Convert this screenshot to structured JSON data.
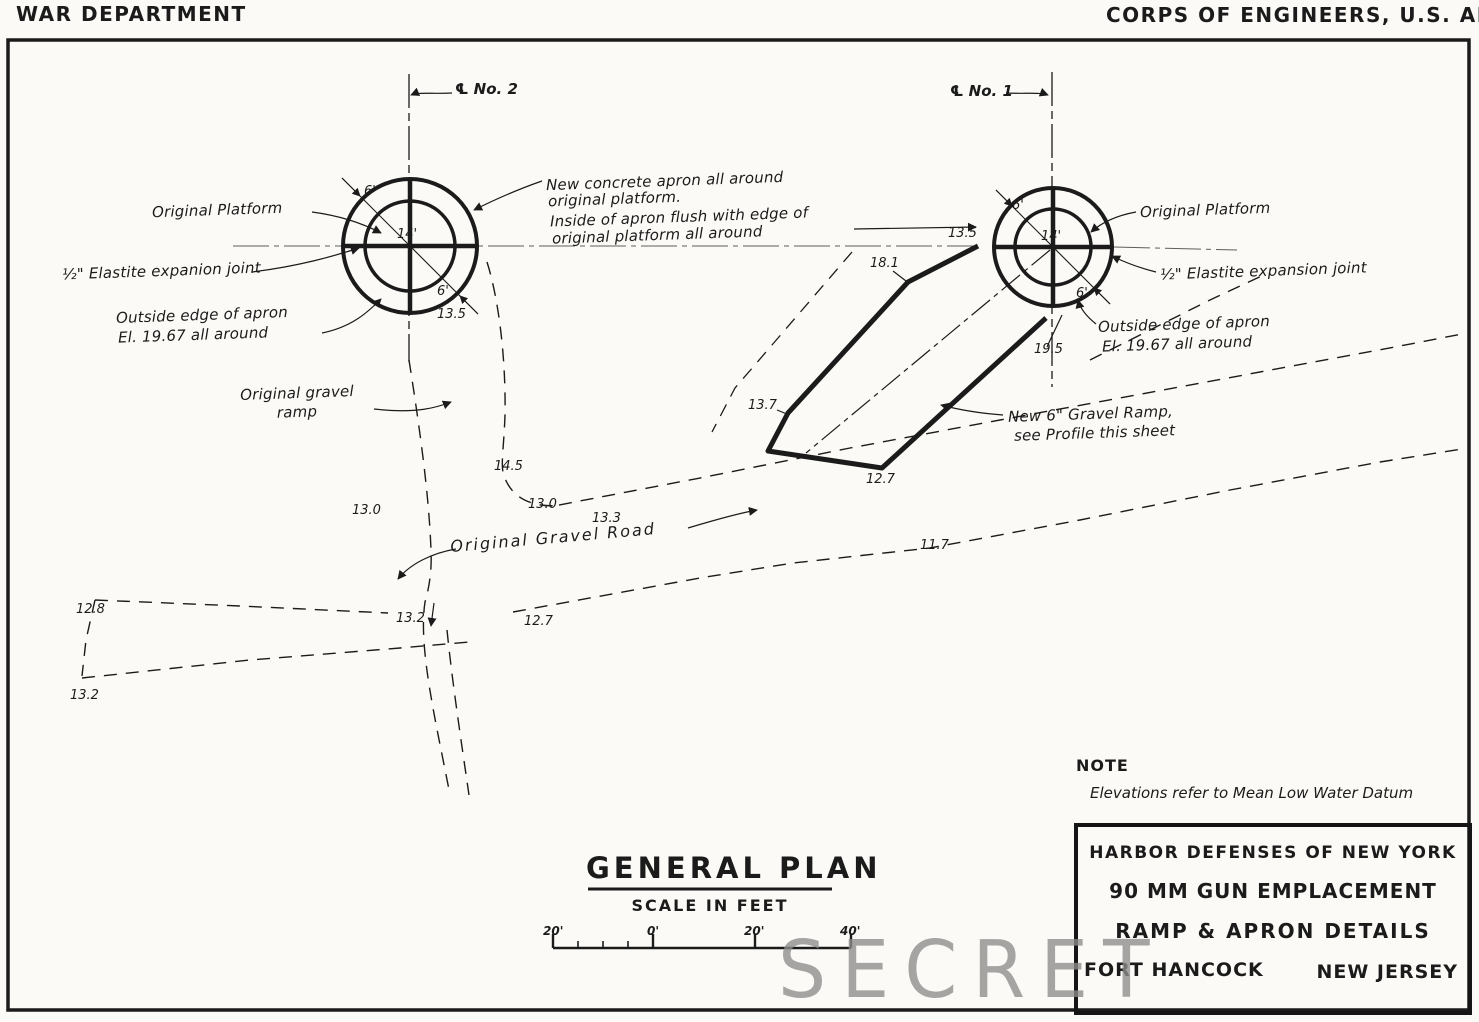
{
  "header": {
    "war_department": "WAR DEPARTMENT",
    "corps": "CORPS OF ENGINEERS, U.S. ARMY"
  },
  "emplacement_left": {
    "centerline_label": "℄ No. 2",
    "platform_label": "Original Platform",
    "joint_label": "½\" Elastite expanion joint",
    "apron_edge_line1": "Outside edge of apron",
    "apron_edge_line2": "El. 19.67 all around",
    "dim_apron_upper": "6'",
    "dim_platform": "14'",
    "dim_apron_lower": "6'",
    "elevation": "13.5"
  },
  "emplacement_right": {
    "centerline_label": "℄ No. 1",
    "platform_label": "Original Platform",
    "joint_label": "½\" Elastite expansion joint",
    "apron_edge_line1": "Outside edge of apron",
    "apron_edge_line2": "El. 19.67 all around",
    "dim_apron_upper": "6'",
    "dim_platform": "14'",
    "dim_apron_lower": "6'",
    "elevation_left": "13.5",
    "elevation_ramp": "19.5"
  },
  "apron_note": {
    "line1": "New concrete apron all around",
    "line2": "original platform.",
    "line3": "Inside of apron flush with edge of",
    "line4": "original platform all around"
  },
  "ramp_note": {
    "line1": "New 6\" Gravel Ramp,",
    "line2": "see Profile this sheet"
  },
  "labels": {
    "gravel_ramp_line1": "Original gravel",
    "gravel_ramp_line2": "ramp",
    "gravel_road": "Original Gravel Road"
  },
  "elevations": {
    "ramp_181": "18.1",
    "ramp_137": "13.7",
    "ramp_127": "12.7",
    "contour_145": "14.5",
    "contour_130a": "13.0",
    "contour_130b": "13.0",
    "contour_133": "13.3",
    "contour_128": "12.8",
    "contour_132a": "13.2",
    "contour_132b": "13.2",
    "contour_127": "12.7",
    "contour_117": "11.7"
  },
  "plan": {
    "title": "GENERAL PLAN",
    "scale_label": "SCALE IN FEET",
    "tick_20l": "20'",
    "tick_0": "0'",
    "tick_20r": "20'",
    "tick_40": "40'"
  },
  "note": {
    "heading": "NOTE",
    "body": "Elevations refer to Mean Low Water Datum"
  },
  "title_block": {
    "line1": "HARBOR DEFENSES OF NEW YORK",
    "line2": "90 MM GUN EMPLACEMENT",
    "line3": "RAMP & APRON DETAILS",
    "fort": "FORT HANCOCK",
    "state": "NEW JERSEY"
  },
  "stamp": {
    "text": "SECRET"
  },
  "colors": {
    "ink": "#1b1b1b",
    "paper": "#fbfaf6",
    "stamp": "#8d8d8d"
  }
}
